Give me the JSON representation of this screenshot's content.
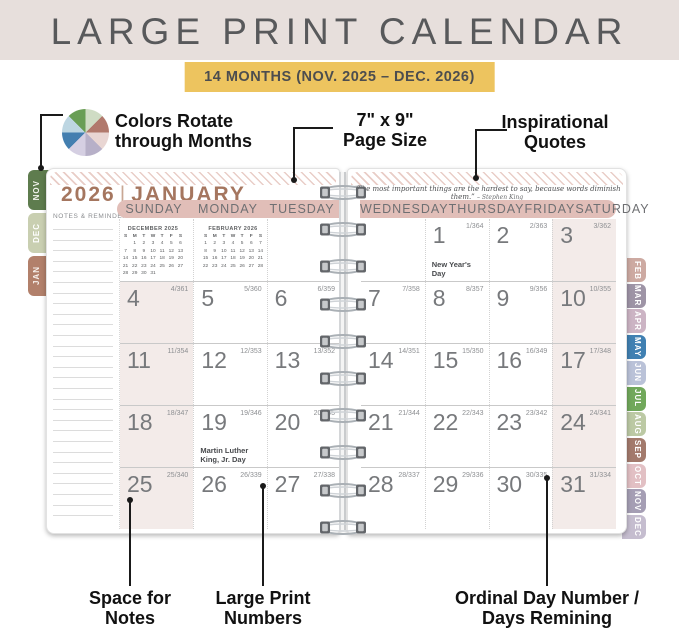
{
  "header": {
    "title": "LARGE PRINT CALENDAR",
    "banner": "14 MONTHS (NOV. 2025 – DEC. 2026)"
  },
  "callouts": {
    "colors_line1": "Colors Rotate",
    "colors_line2": "through Months",
    "pagesize_line1": "7\" x 9\"",
    "pagesize_line2": "Page Size",
    "quotes_line1": "Inspirational",
    "quotes_line2": "Quotes",
    "notes_line1": "Space for",
    "notes_line2": "Notes",
    "largeprint_line1": "Large Print",
    "largeprint_line2": "Numbers",
    "ordinal_line1": "Ordinal Day Number /",
    "ordinal_line2": "Days Remining"
  },
  "color_wheel": {
    "segments": [
      "#cfdcc4",
      "#b1796c",
      "#e9d6d3",
      "#b7b0c8",
      "#d5cfe2",
      "#447fb0",
      "#bdd6e2",
      "#699e55"
    ]
  },
  "colors": {
    "header_bg": "#e7dfdc",
    "title_text": "#58595b",
    "banner_bg": "#edc45f",
    "banner_text": "#4c4d4f",
    "band": "#e1beb8",
    "weekend": "#f3ebe9",
    "month_title": "#a5765f",
    "hatch": "#e9cdc7",
    "page_border": "#e2e2e2"
  },
  "calendar": {
    "year": "2026",
    "divider": "|",
    "month": "JANUARY",
    "notes_label": "NOTES & REMINDERS",
    "quote_text": "“The most important things are the hardest to say, because words diminish them.”",
    "quote_author": "– Stephen King",
    "left_day_headers": [
      "SUNDAY",
      "MONDAY",
      "TUESDAY"
    ],
    "right_day_headers": [
      "WEDNESDAY",
      "THURSDAY",
      "FRIDAY",
      "SATURDAY"
    ],
    "left_tabs": [
      {
        "label": "NOV",
        "color": "#5e7c4e",
        "text_color": "#f4f6f0"
      },
      {
        "label": "DEC",
        "color": "#c9cfb1",
        "text_color": "#ffffff"
      },
      {
        "label": "JAN",
        "color": "#b2806b",
        "text_color": "#f7f0ec"
      }
    ],
    "right_tabs": [
      {
        "label": "FEB",
        "color": "#cdaaa2",
        "text_color": "#ffffff"
      },
      {
        "label": "MAR",
        "color": "#9e94a6",
        "text_color": "#ffffff"
      },
      {
        "label": "APR",
        "color": "#ccb4c4",
        "text_color": "#ffffff"
      },
      {
        "label": "MAY",
        "color": "#4080b2",
        "text_color": "#ffffff"
      },
      {
        "label": "JUN",
        "color": "#bac2d8",
        "text_color": "#ffffff"
      },
      {
        "label": "JUL",
        "color": "#71a85b",
        "text_color": "#ffffff"
      },
      {
        "label": "AUG",
        "color": "#bcc9a4",
        "text_color": "#ffffff"
      },
      {
        "label": "SEP",
        "color": "#a37a6c",
        "text_color": "#ffffff"
      },
      {
        "label": "OCT",
        "color": "#e2c0c4",
        "text_color": "#ffffff"
      },
      {
        "label": "NOV",
        "color": "#a59eb4",
        "text_color": "#ffffff"
      },
      {
        "label": "DEC",
        "color": "#c5bdcf",
        "text_color": "#ffffff"
      }
    ],
    "mini_calendars": [
      {
        "title": "DECEMBER 2025",
        "dow": [
          "S",
          "M",
          "T",
          "W",
          "T",
          "F",
          "S"
        ],
        "weeks": [
          [
            "",
            "1",
            "2",
            "3",
            "4",
            "5",
            "6"
          ],
          [
            "7",
            "8",
            "9",
            "10",
            "11",
            "12",
            "13"
          ],
          [
            "14",
            "15",
            "16",
            "17",
            "18",
            "19",
            "20"
          ],
          [
            "21",
            "22",
            "23",
            "24",
            "25",
            "26",
            "27"
          ],
          [
            "28",
            "29",
            "30",
            "31",
            "",
            "",
            ""
          ]
        ]
      },
      {
        "title": "FEBRUARY 2026",
        "dow": [
          "S",
          "M",
          "T",
          "W",
          "T",
          "F",
          "S"
        ],
        "weeks": [
          [
            "1",
            "2",
            "3",
            "4",
            "5",
            "6",
            "7"
          ],
          [
            "8",
            "9",
            "10",
            "11",
            "12",
            "13",
            "14"
          ],
          [
            "15",
            "16",
            "17",
            "18",
            "19",
            "20",
            "21"
          ],
          [
            "22",
            "23",
            "24",
            "25",
            "26",
            "27",
            "28"
          ]
        ]
      }
    ],
    "left_rows": [
      [
        {
          "day": "4",
          "ordinal": "4/361"
        },
        {
          "day": "5",
          "ordinal": "5/360"
        },
        {
          "day": "6",
          "ordinal": "6/359"
        }
      ],
      [
        {
          "day": "11",
          "ordinal": "11/354"
        },
        {
          "day": "12",
          "ordinal": "12/353"
        },
        {
          "day": "13",
          "ordinal": "13/352"
        }
      ],
      [
        {
          "day": "18",
          "ordinal": "18/347"
        },
        {
          "day": "19",
          "ordinal": "19/346",
          "note": "Martin Luther King, Jr. Day"
        },
        {
          "day": "20",
          "ordinal": "20/345"
        }
      ],
      [
        {
          "day": "25",
          "ordinal": "25/340"
        },
        {
          "day": "26",
          "ordinal": "26/339"
        },
        {
          "day": "27",
          "ordinal": "27/338"
        }
      ]
    ],
    "right_rows": [
      [
        {},
        {
          "day": "1",
          "ordinal": "1/364",
          "note": "New Year's Day"
        },
        {
          "day": "2",
          "ordinal": "2/363"
        },
        {
          "day": "3",
          "ordinal": "3/362"
        }
      ],
      [
        {
          "day": "7",
          "ordinal": "7/358"
        },
        {
          "day": "8",
          "ordinal": "8/357"
        },
        {
          "day": "9",
          "ordinal": "9/356"
        },
        {
          "day": "10",
          "ordinal": "10/355"
        }
      ],
      [
        {
          "day": "14",
          "ordinal": "14/351"
        },
        {
          "day": "15",
          "ordinal": "15/350"
        },
        {
          "day": "16",
          "ordinal": "16/349"
        },
        {
          "day": "17",
          "ordinal": "17/348"
        }
      ],
      [
        {
          "day": "21",
          "ordinal": "21/344"
        },
        {
          "day": "22",
          "ordinal": "22/343"
        },
        {
          "day": "23",
          "ordinal": "23/342"
        },
        {
          "day": "24",
          "ordinal": "24/341"
        }
      ],
      [
        {
          "day": "28",
          "ordinal": "28/337"
        },
        {
          "day": "29",
          "ordinal": "29/336"
        },
        {
          "day": "30",
          "ordinal": "30/335"
        },
        {
          "day": "31",
          "ordinal": "31/334"
        }
      ]
    ]
  }
}
